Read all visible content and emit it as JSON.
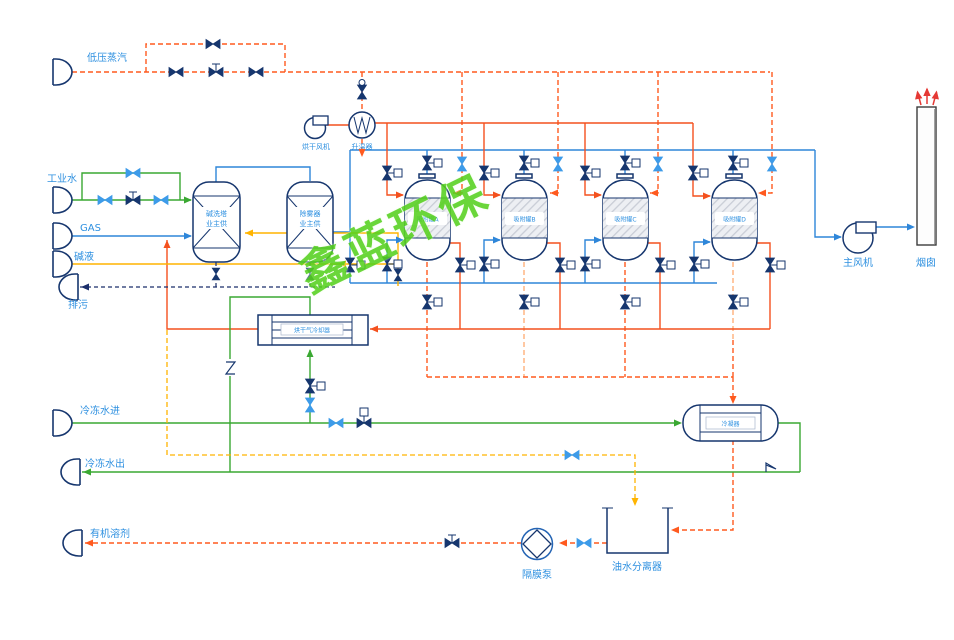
{
  "watermark": "鑫蓝环保",
  "colors": {
    "steam_line": "#ff5a1f",
    "process_gas_line": "#2e86d9",
    "water_line": "#3aa832",
    "alkali_line": "#ffb400",
    "drain_line": "#1b2f6b",
    "label_text": "#2e90e0",
    "watermark_green": "#56d11f",
    "stack_arrows_red": "#e53935",
    "equipment_outline": "#16366e"
  },
  "streams": {
    "steam": "低压蒸汽",
    "industrial_water": "工业水",
    "gas": "GAS",
    "alkali": "碱液",
    "drain": "排污",
    "chilled_water_in": "冷冻水进",
    "chilled_water_out": "冷冻水出",
    "organic_solvent": "有机溶剂"
  },
  "equipment": {
    "drying_fan": "烘干风机",
    "heater": "升温器",
    "scrubber_line1": "碱洗塔",
    "scrubber_line2": "业主供",
    "demister_line1": "除雾器",
    "demister_line2": "业主供",
    "adsorber_a": "吸附罐A",
    "adsorber_b": "吸附罐B",
    "adsorber_c": "吸附罐C",
    "adsorber_d": "吸附罐D",
    "drying_gas_cooler": "烘干气冷却器",
    "condenser": "冷凝器",
    "main_fan": "主风机",
    "chimney": "烟囱",
    "diaphragm_pump": "隔膜泵",
    "oil_water_separator": "油水分离器"
  }
}
